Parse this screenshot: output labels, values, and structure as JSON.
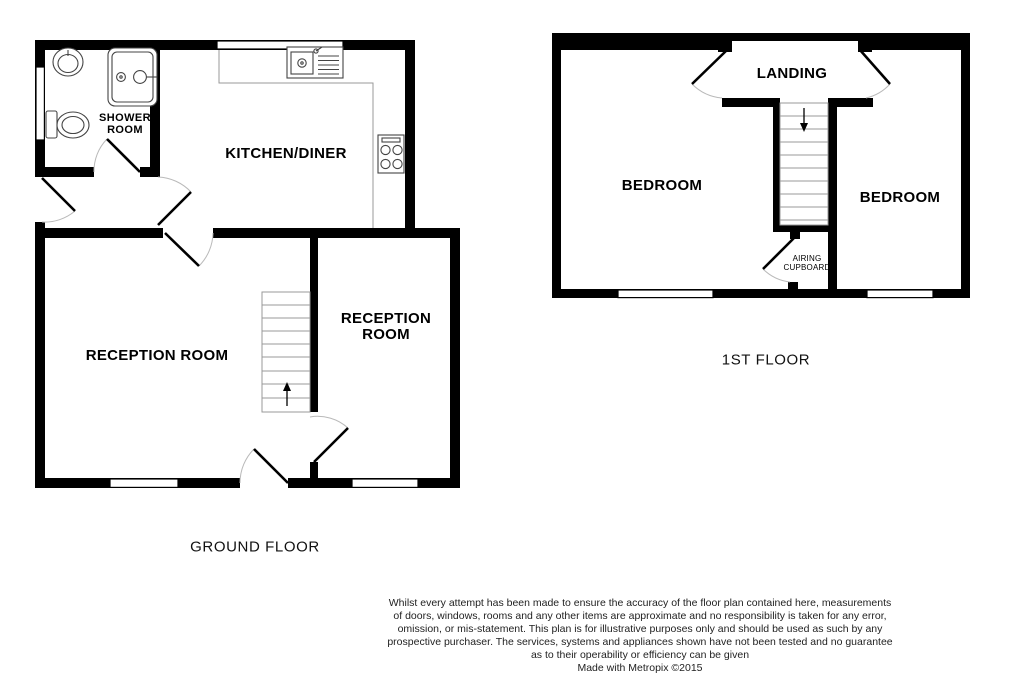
{
  "ground_floor": {
    "title": "GROUND FLOOR",
    "rooms": {
      "shower_room": "SHOWER ROOM",
      "kitchen_diner": "KITCHEN/DINER",
      "reception_left": "RECEPTION ROOM",
      "reception_right": "RECEPTION ROOM"
    }
  },
  "first_floor": {
    "title": "1ST FLOOR",
    "rooms": {
      "landing": "LANDING",
      "bedroom_left": "BEDROOM",
      "bedroom_right": "BEDROOM",
      "airing_cupboard": "AIRING CUPBOARD"
    }
  },
  "disclaimer": {
    "lines": [
      "Whilst every attempt has been made to ensure the accuracy of the floor plan contained here, measurements",
      "of doors, windows, rooms and any other items are approximate and no responsibility is taken for any error,",
      "omission, or mis-statement. This plan is for illustrative purposes only and should be used as such by any",
      "prospective purchaser. The services, systems and appliances shown have not been tested and no guarantee",
      "as to their operability or efficiency can be given",
      "Made with Metropix ©2015"
    ]
  },
  "colors": {
    "wall": "#000000",
    "background": "#ffffff",
    "fixture_line": "#444444",
    "stair_line": "#999999",
    "door_arc": "#b9b9b9"
  }
}
